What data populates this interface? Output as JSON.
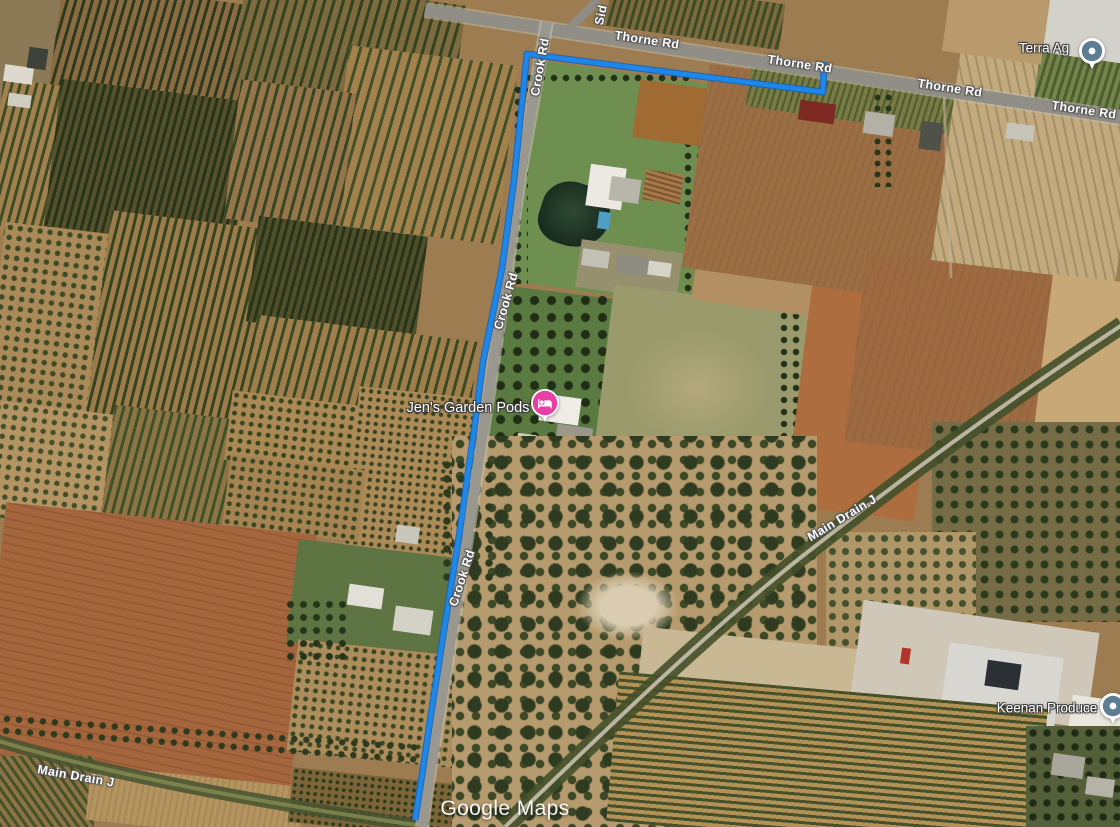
{
  "map_labels": {
    "thorne_rd": "Thorne Rd",
    "crook_rd": "Crook Rd",
    "main_drain_j": "Main Drain J",
    "siding_rd_partial": "Sid",
    "watermark": "Google Maps"
  },
  "places": {
    "terra_ag": {
      "name": "Terra Ag",
      "pin": "generic"
    },
    "jens_garden_pods": {
      "name": "Jen's Garden Pods",
      "pin": "lodging"
    },
    "keenan_produce": {
      "name": "Keenan Produce",
      "pin": "generic"
    }
  },
  "route": {
    "color": "#1e88e8",
    "casing_color": "#0f62c4",
    "points": "824,62 823,92 527,54 514,180 502,268 483,362 474,431 459,536 444,630 431,714 422,775 415,820"
  },
  "pin_colors": {
    "generic": "#5e7d92",
    "lodging": "#e83fa4"
  }
}
